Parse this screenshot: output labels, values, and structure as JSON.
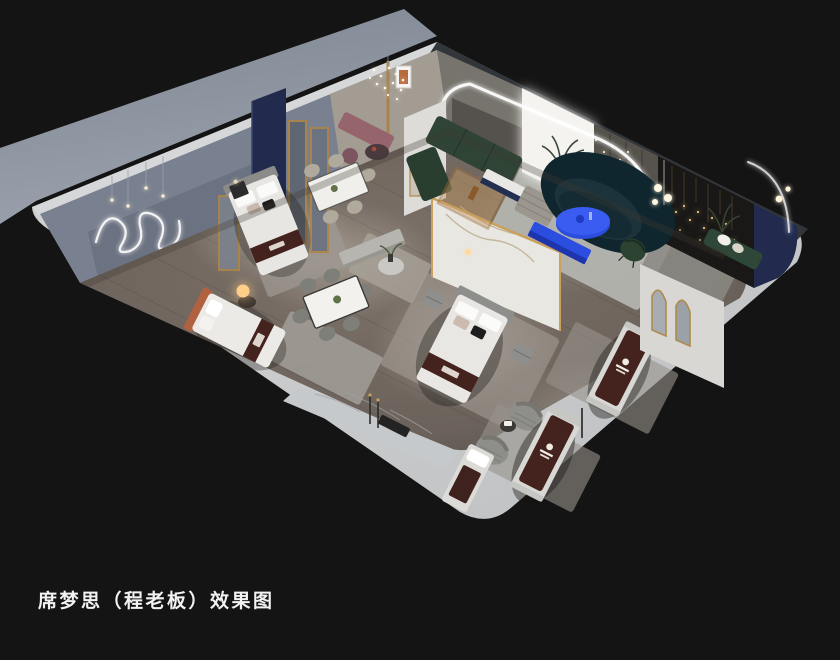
{
  "caption": {
    "text": "席梦思（程老板）效果图",
    "color": "#f2f2f2"
  },
  "scene": {
    "kind": "isometric-cutaway-interior-render",
    "subject": "mattress showroom with bedroom, dining and lounge displays",
    "colors": {
      "background": "#141414",
      "ground_plane": "#8e95a1",
      "wall_cut_light": "#c8cacb",
      "wall_cut_dark": "#33363a",
      "wall_interior_blue_gray": "#79808f",
      "wall_interior_beige": "#a29c93",
      "floor_wood": "#6e655f",
      "rug_light": "#b3b4af",
      "marble_white": "#e9e7e2",
      "window_glow": "#f4f3ef",
      "led_white": "#ffffff",
      "accent_blue": "#2b4de0",
      "sofa_teal": "#10262e",
      "sofa_green": "#2f4435",
      "bench_green": "#2e4736",
      "runner_burgundy": "#44221d",
      "headboard_orange": "#b06240",
      "bench_mauve": "#96646c",
      "navy_panel": "#222b4e",
      "gold_trim": "#b08a4c",
      "fairy_light_gold": "#e8c27a",
      "lamp_warm": "#ffcf8a",
      "black_feature_wall": "#191817"
    },
    "objects": [
      {
        "name": "bed-display-left",
        "note": "gray headboard, white bedding, burgundy brand runner"
      },
      {
        "name": "bed-display-orange",
        "note": "terracotta headboard, glowing orb lamp"
      },
      {
        "name": "bed-display-center",
        "note": "marble feature wall with gold trim behind"
      },
      {
        "name": "mattress-display-1",
        "note": "burgundy cover with white logo"
      },
      {
        "name": "mattress-display-2",
        "note": "burgundy cover with white logo"
      },
      {
        "name": "mattress-display-3",
        "note": "partially behind front wall"
      },
      {
        "name": "dining-table-upper",
        "note": "white marble top, beige chairs"
      },
      {
        "name": "dining-table-lower",
        "note": "white marble top, gray chairs"
      },
      {
        "name": "sofa-green-modular"
      },
      {
        "name": "sofa-curved-teal"
      },
      {
        "name": "coffee-table-blue"
      },
      {
        "name": "tv-console-blue"
      },
      {
        "name": "swivel-armchairs-gray"
      },
      {
        "name": "arch-partition-led"
      },
      {
        "name": "arch-mirror-partition"
      },
      {
        "name": "gold-framed-mirrors"
      },
      {
        "name": "fairy-light-wall"
      },
      {
        "name": "squiggle-neon-art"
      },
      {
        "name": "marble-walkway-with-floor-lamps"
      }
    ]
  }
}
